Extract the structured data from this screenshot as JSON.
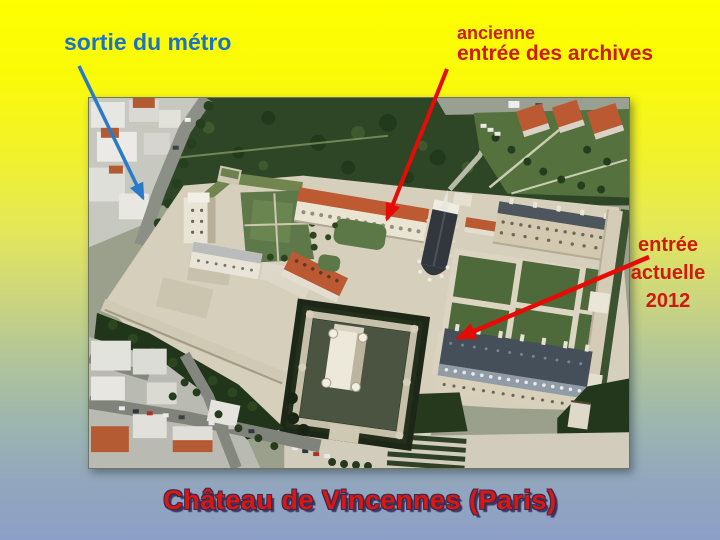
{
  "title": "Château de Vincennes (Paris)",
  "labels": {
    "metro": "sortie du métro",
    "archives": [
      "ancienne",
      "entrée des archives"
    ],
    "entrance": [
      "entrée",
      "actuelle",
      "2012"
    ]
  },
  "photo": {
    "subject": "aerial view of Château de Vincennes"
  },
  "colors": {
    "label_blue": "#1a73c8",
    "label_red": "#ce1b0d",
    "arrow_blue": "#2a7ac9",
    "arrow_red": "#e50b06",
    "title_red": "#dc1712",
    "title_outline": "#332b52",
    "background_top": "#feff00",
    "background_bottom": "#8c9fc6"
  }
}
